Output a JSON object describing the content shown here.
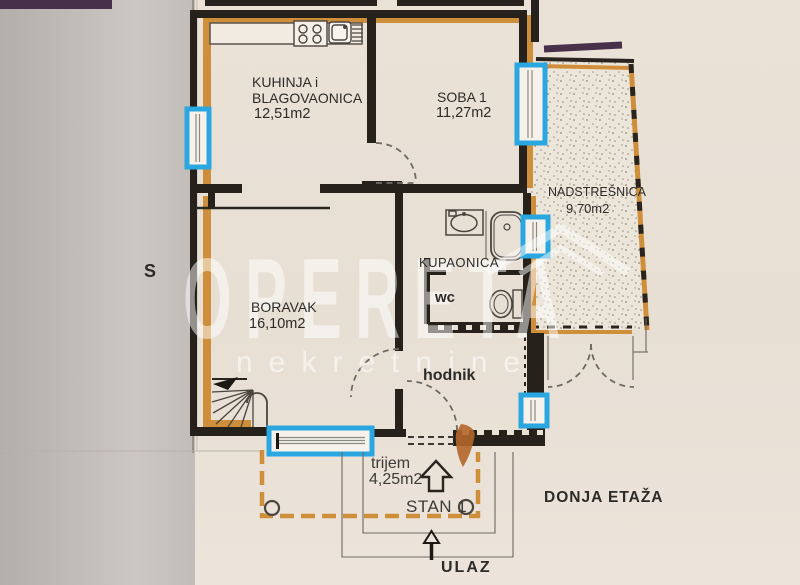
{
  "watermark": {
    "brand": "OPERETA",
    "tagline": "nekretnine"
  },
  "rooms": {
    "kitchen": {
      "name_line1": "KUHINJA i",
      "name_line2": "BLAGOVAONICA",
      "area": "12,51m2"
    },
    "soba1": {
      "name": "SOBA 1",
      "area": "11,27m2"
    },
    "nadstresnica": {
      "name": "NADSTREŠNICA",
      "area": "9,70m2"
    },
    "boravak": {
      "name": "BORAVAK",
      "area": "16,10m2"
    },
    "kupaonica": {
      "name": "KUPAONICA"
    },
    "wc": {
      "name": "wc"
    },
    "hodnik": {
      "name": "hodnik"
    },
    "trijem": {
      "name": "trijem",
      "area": "4,25m2"
    }
  },
  "annotations": {
    "unit_label": "STAN 1",
    "floor_label": "DONJA ETAŽA",
    "entrance_label": "ULAZ",
    "north_label": "S"
  },
  "colors": {
    "window_highlight": "#2aa7e0",
    "wall_accent_orange": "#cf8f3a",
    "roof_purple": "#46304a",
    "wall_black": "#27211c"
  },
  "icons": [
    "stove-icon",
    "kitchen-sink-icon",
    "washbasin-icon",
    "bathtub-icon",
    "toilet-icon",
    "stairs-icon",
    "window-marker",
    "door-swing-arc",
    "column-marker",
    "direction-arrow-icon",
    "entrance-arrow-icon",
    "roof-swoosh-icon"
  ]
}
